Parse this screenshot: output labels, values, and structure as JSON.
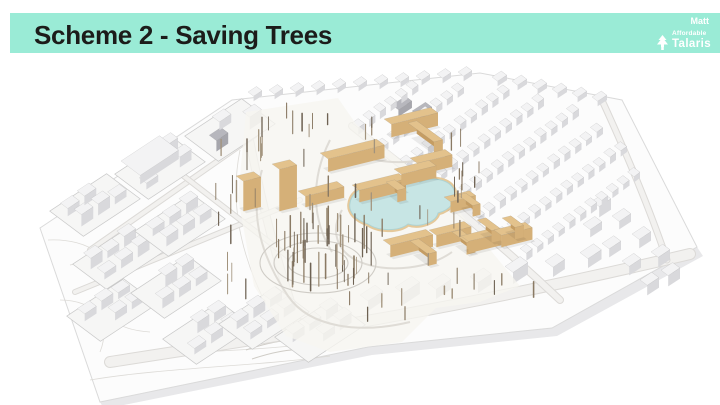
{
  "slide": {
    "header": {
      "title": "Scheme 2 - Saving Trees",
      "band_color": "#9aebd6",
      "title_color": "#1c1c1a",
      "author": "Matt",
      "brand": {
        "line1": "Affordable",
        "line2": "Talaris",
        "text_color": "#ffffff"
      }
    }
  },
  "illustration": {
    "kind": "aerial-3d-site-massing-model",
    "colors": {
      "plinth": "#fcfcfc",
      "plinth_side": "#e8e8ea",
      "plinth_edge": "#dadada",
      "context_top": "#f3f3f4",
      "context_side": "#c3c3c7",
      "context_front": "#d9d9dc",
      "dark_top": "#b7b7bd",
      "dark_side": "#94949a",
      "dark_front": "#a6a6ac",
      "wood_top": "#e3c28c",
      "wood_side": "#c59d63",
      "wood_front": "#d5b078",
      "pond": "#c7e5e4",
      "pond_edge": "#aed3d3",
      "sand": "#e5c99b",
      "sand_fill": "#f3e7cb",
      "road": "#f2f1ef",
      "road_edge": "#dcdad7",
      "contour": "#d9d7d3",
      "ring": "#cfccc6",
      "site_tint": "#f7f5f0",
      "tree_dark": "#6e6253",
      "tree_mid": "#8a7a64",
      "tree_light": "#a2937d",
      "block_fill": "#f6f6f5",
      "block_stroke": "#c9c9c9"
    }
  }
}
